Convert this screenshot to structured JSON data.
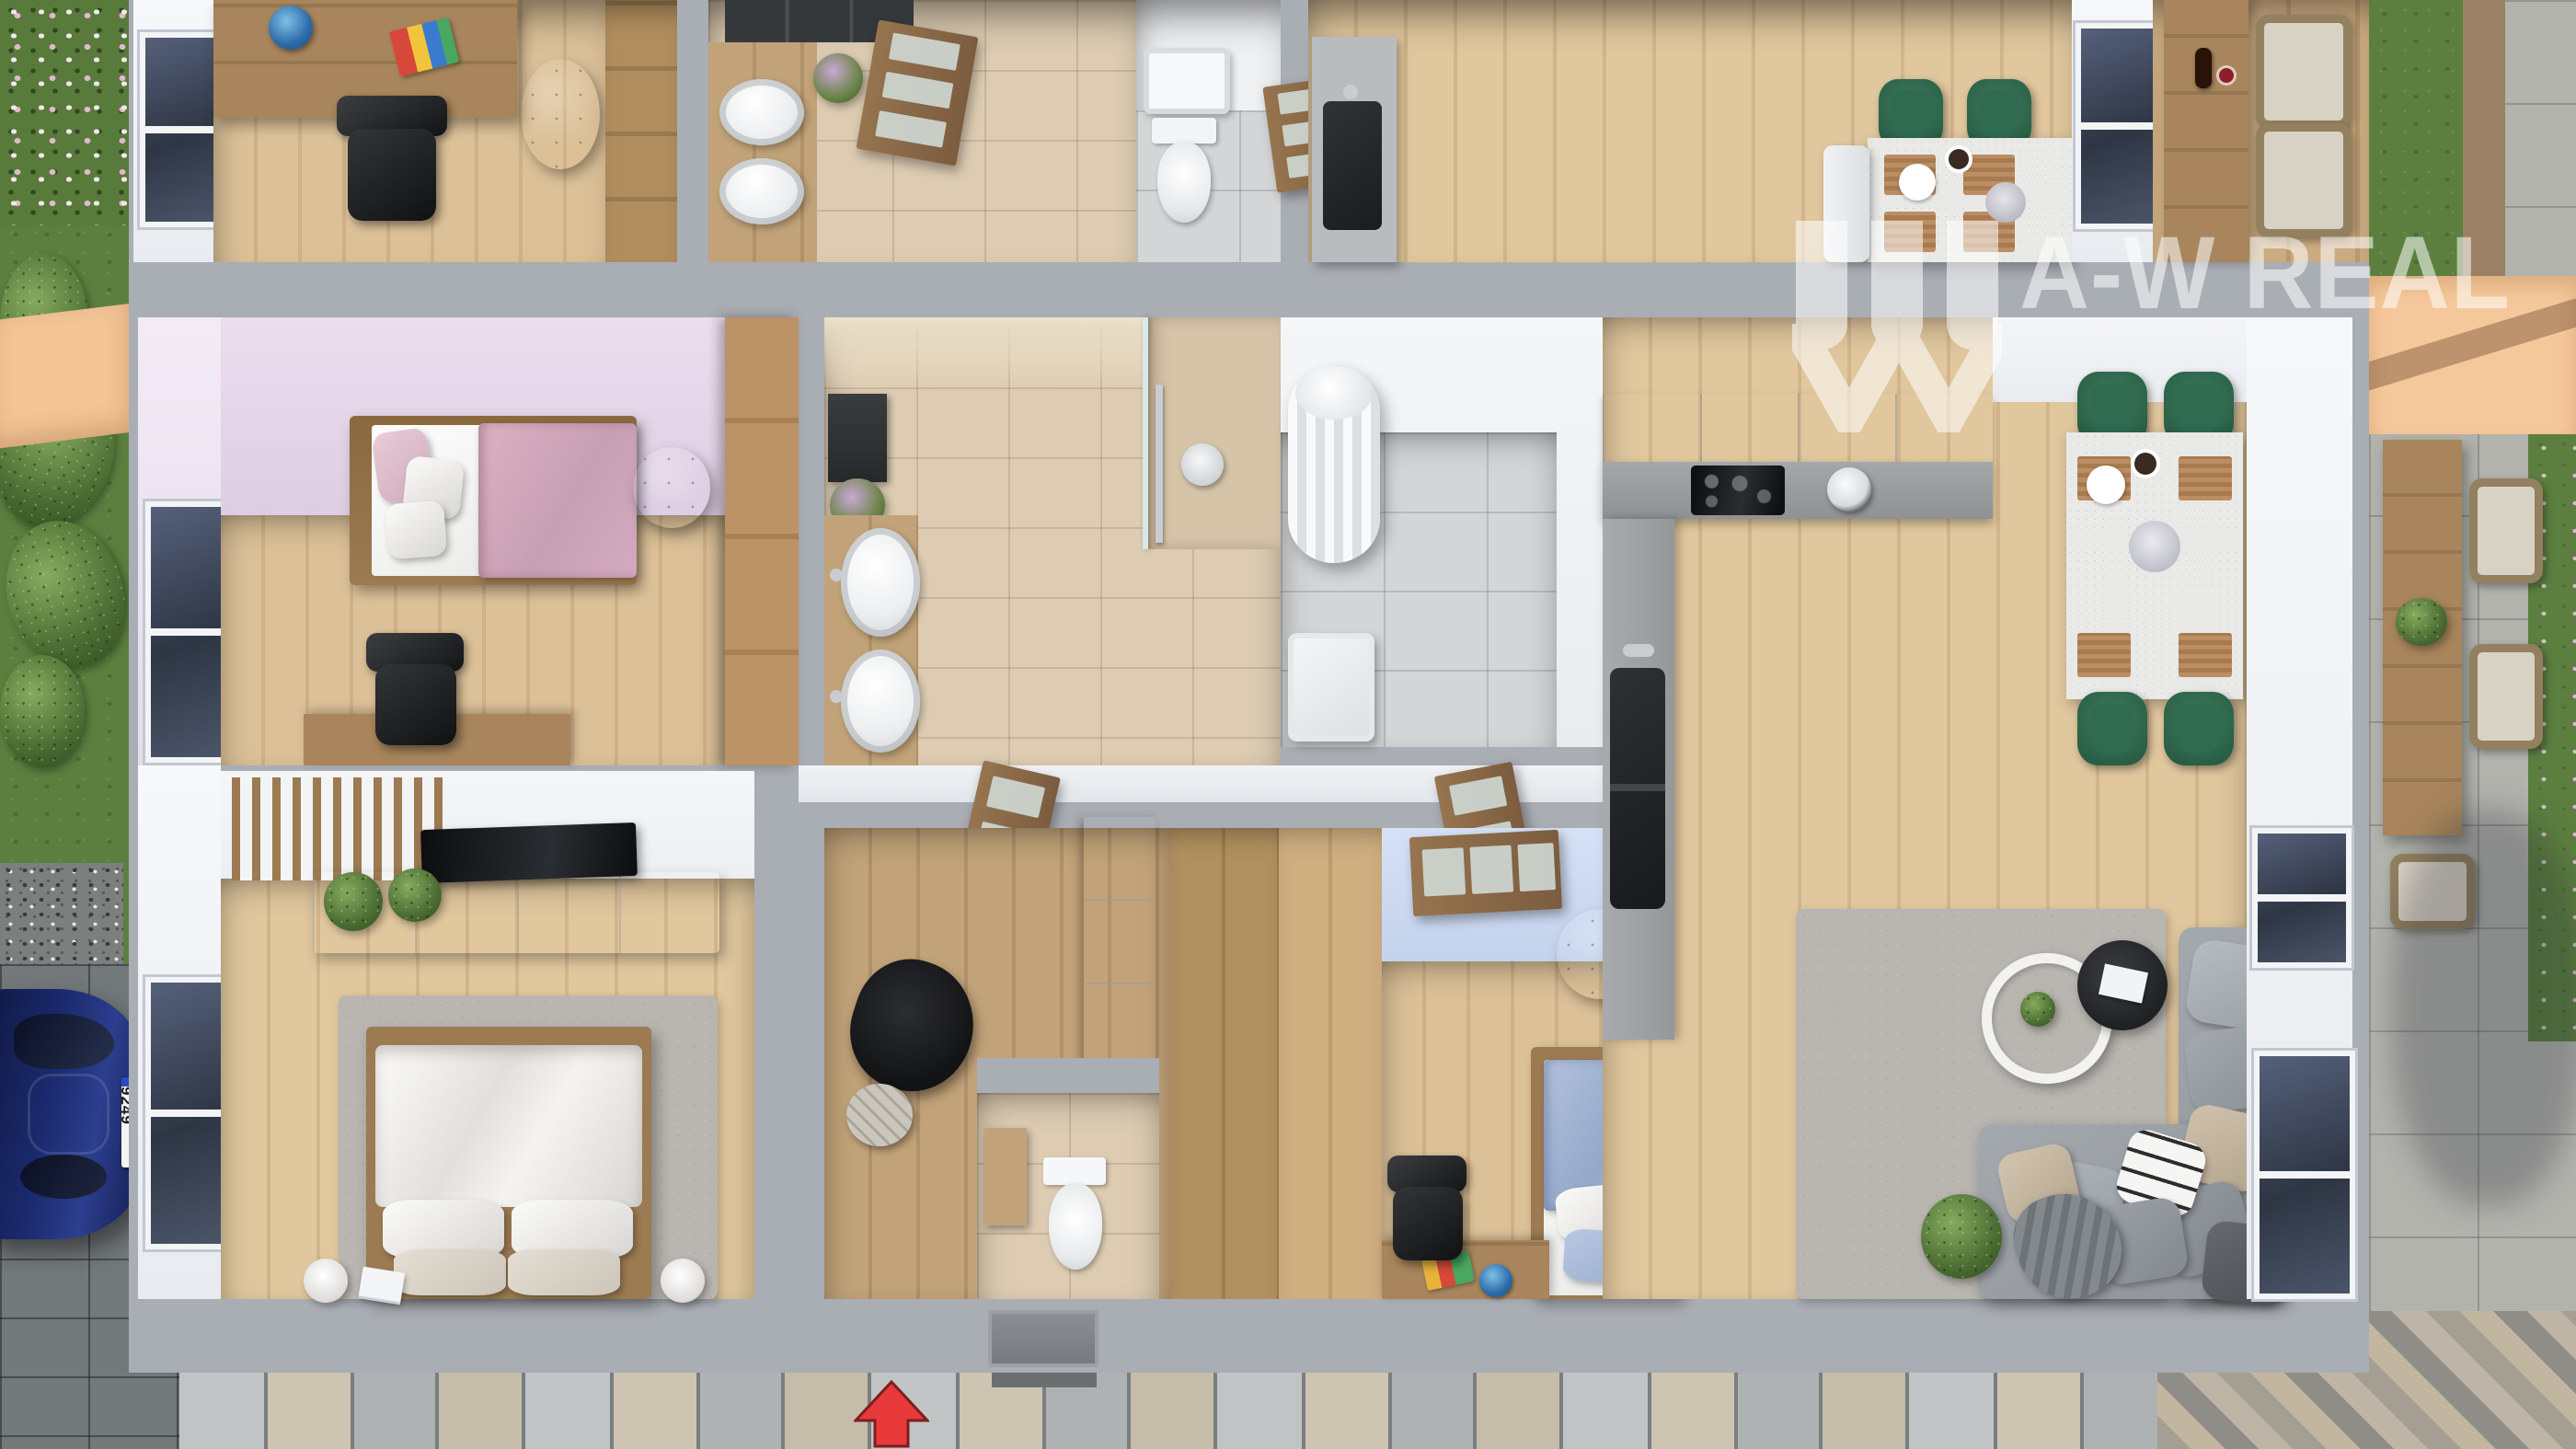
{
  "scene": {
    "kind": "3d-floor-plan-render",
    "view": "top-down cutaway of single-storey duplex house with garden, driveway and terrace"
  },
  "watermark": {
    "text": "A-W REAL",
    "icon": "w-roof-bars-logo-icon",
    "color": "#ffffff",
    "opacity": 0.55
  },
  "vehicle": {
    "license_plate": "M·NU 9249",
    "body_color": "#1b2a6e"
  },
  "entrance": {
    "marker": "red-up-arrow",
    "color": "#e8393b"
  },
  "palette": {
    "wall_outer": "#a9adb4",
    "wall_face": "#f1f3f5",
    "floor_wood": "#d6bb92",
    "floor_wood_dark": "#c0a077",
    "tile_beige": "#ddccb2",
    "tile_gray": "#d3d5d7",
    "wall_pink": "#e8dcec",
    "wall_blue": "#cfdcf2",
    "chair_green": "#2e6b51",
    "sofa_gray": "#9aa0a6",
    "arrow_red": "#e8393b",
    "awning_peach": "#f5c89b",
    "grass": "#5c7f3f",
    "pavement": "#b9bdbe",
    "car_blue": "#1b2a66",
    "door_wood": "#8a6b4f"
  },
  "rooms": [
    {
      "id": "office-upper-unit",
      "furniture": [
        "desk",
        "office-chair",
        "globe",
        "books",
        "pouf",
        "wardrobe",
        "window"
      ]
    },
    {
      "id": "bathroom-upper-unit",
      "furniture": [
        "mirror-cabinet",
        "double-sink-vanity",
        "flowers",
        "door"
      ]
    },
    {
      "id": "wc-upper-unit",
      "furniture": [
        "shower-tray",
        "toilet",
        "door"
      ]
    },
    {
      "id": "kitchen-upper-unit",
      "furniture": [
        "sink-counter",
        "dining-table",
        "green-chairs",
        "bench",
        "window"
      ]
    },
    {
      "id": "kids-bedroom-pink",
      "furniture": [
        "single-bed",
        "pink-duvet",
        "pillows",
        "pouf",
        "wardrobe",
        "desk",
        "office-chair",
        "window"
      ]
    },
    {
      "id": "bathroom-main",
      "furniture": [
        "mirror-cabinet",
        "flowers",
        "double-sink-vanity",
        "shower",
        "glass-partition",
        "door"
      ]
    },
    {
      "id": "utility-room",
      "furniture": [
        "water-heater",
        "washing-machine"
      ]
    },
    {
      "id": "master-bedroom",
      "furniture": [
        "double-bed",
        "pillows",
        "rug",
        "tv",
        "tv-console",
        "wood-slat-panel",
        "plants",
        "bedside-lamps",
        "magazines",
        "window"
      ]
    },
    {
      "id": "hallway",
      "furniture": [
        "coat",
        "cap",
        "tall-cabinet"
      ]
    },
    {
      "id": "wc-small",
      "furniture": [
        "toilet",
        "wall-cabinet"
      ]
    },
    {
      "id": "kids-bedroom-blue",
      "furniture": [
        "single-bed",
        "blue-duvet",
        "pillows",
        "pouf",
        "desk",
        "toys",
        "globe",
        "office-chair",
        "door",
        "wardrobe-wall"
      ]
    },
    {
      "id": "kitchen-main",
      "furniture": [
        "l-shaped-counter",
        "cooktop",
        "kettle",
        "sink"
      ]
    },
    {
      "id": "dining-area",
      "furniture": [
        "table",
        "green-chairs",
        "placemats",
        "vase",
        "coffee-cup"
      ]
    },
    {
      "id": "living-room",
      "furniture": [
        "corner-sofa",
        "pillows",
        "letter-print-pillow",
        "throw",
        "nesting-coffee-tables",
        "magazine",
        "rug",
        "potted-plant",
        "windows"
      ]
    },
    {
      "id": "terrace",
      "furniture": [
        "peach-awning",
        "outdoor-table",
        "outdoor-chairs",
        "succulent-bowl",
        "stone-pavers",
        "lawn-strip"
      ]
    },
    {
      "id": "garden",
      "furniture": [
        "flower-bed",
        "bushes",
        "gravel-bed",
        "driveway",
        "car",
        "paved-walkway",
        "doormat",
        "entrance-arrow"
      ]
    }
  ]
}
